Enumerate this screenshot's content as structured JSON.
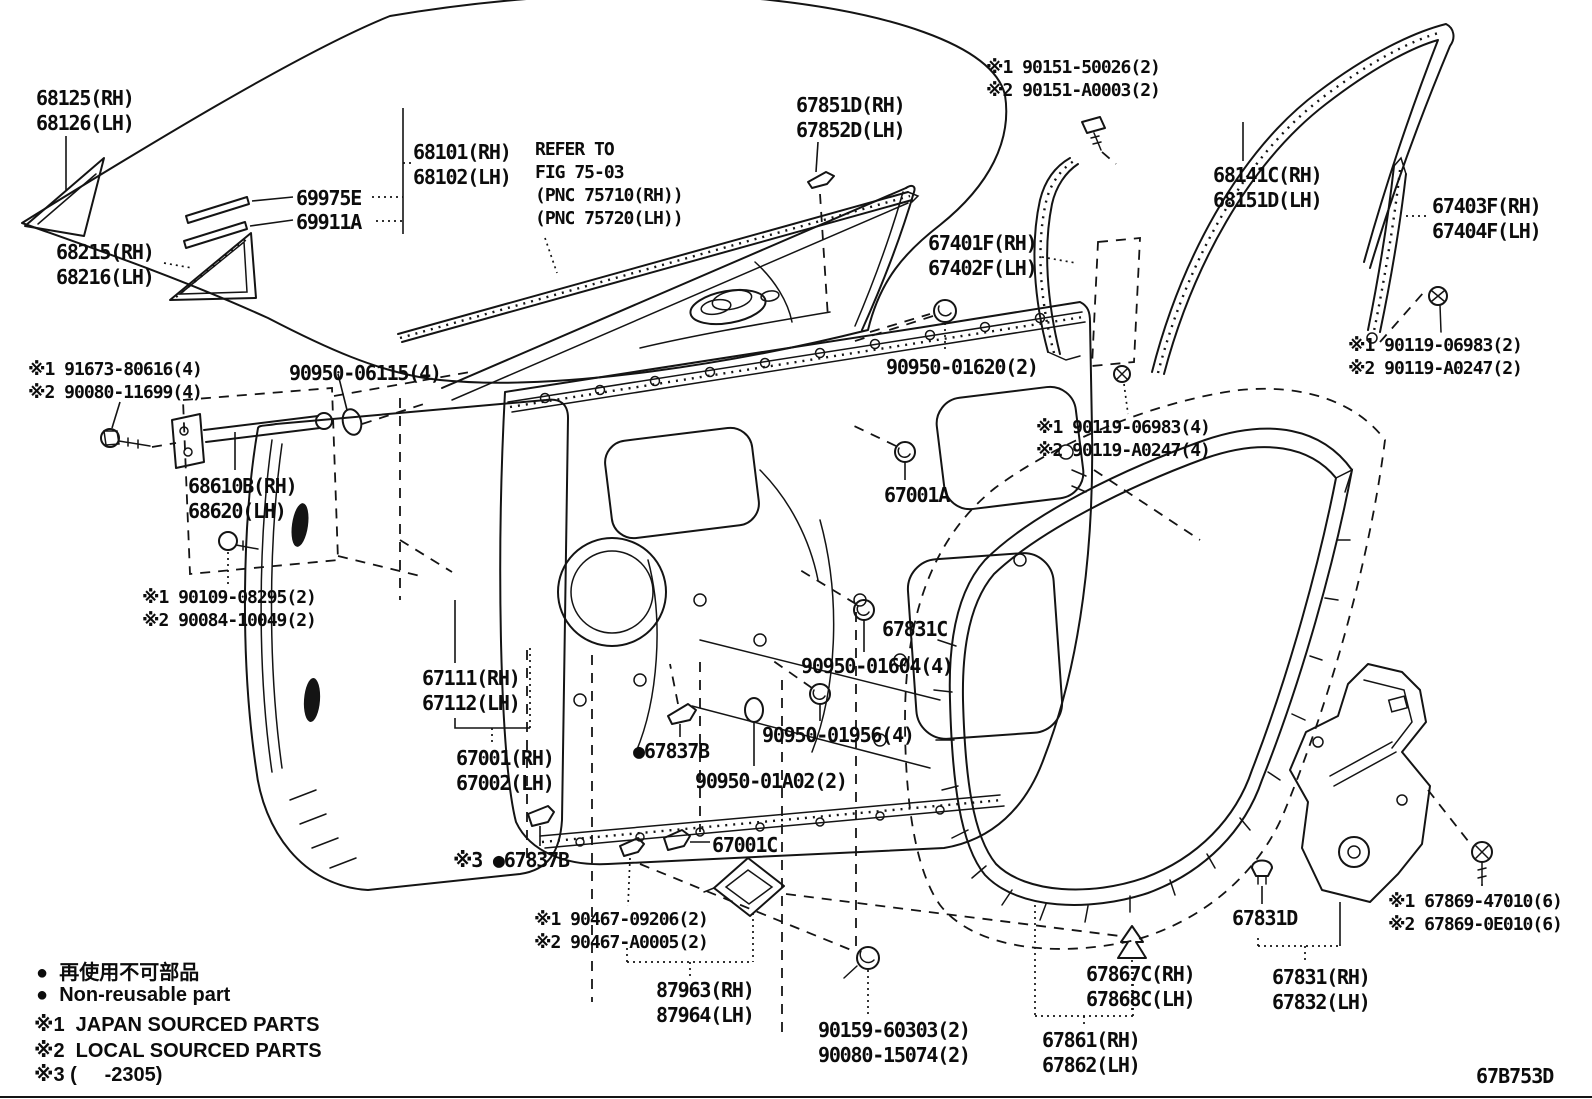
{
  "figure_code": "67B753D",
  "labels": {
    "glass_qtr": "68125(RH)\n68126(LH)",
    "door_glass": "68101(RH)\n68102(LH)",
    "ws_outer": "69975E",
    "ws_inner": "69911A",
    "vent_seal": "68215(RH)\n68216(LH)",
    "refer_note": "REFER TO\nFIG 75-03\n(PNC 75710(RH))\n(PNC 75720(LH))",
    "belt_mldg": "67851D(RH)\n67852D(LH)",
    "screw_90151": "※1 90151-50026(2)\n※2 90151-A0003(2)",
    "glass_run": "68141C(RH)\n68151D(LH)",
    "run_rear": "67403F(RH)\n67404F(LH)",
    "run_front": "67401F(RH)\n67402F(LH)",
    "gr_01620": "90950-01620(2)",
    "bolt_90119_2": "※1 90119-06983(2)\n※2 90119-A0247(2)",
    "bolt_90119_4": "※1 90119-06983(4)\n※2 90119-A0247(4)",
    "bolt_91673": "※1 91673-80616(4)\n※2 90080-11699(4)",
    "gr_06115": "90950-06115(4)",
    "door_check": "68610B(RH)\n68620(LH)",
    "bolt_90109": "※1 90109-08295(2)\n※2 90084-10049(2)",
    "p67001A": "67001A",
    "p67831C": "67831C",
    "gr_01604": "90950-01604(4)",
    "gr_01956": "90950-01956(4)",
    "clip_67837B": "●67837B",
    "gr_01A02": "90950-01A02(2)",
    "door_panel": "67111(RH)\n67112(LH)",
    "door_assy": "67001(RH)\n67002(LH)",
    "clip_67837B2": "※3 ●67837B",
    "p67001C": "67001C",
    "screw_90467": "※1 90467-09206(2)\n※2 90467-A0005(2)",
    "stabilizer": "87963(RH)\n87964(LH)",
    "screw_90159": "90159-60303(2)\n90080-15074(2)",
    "clip_67867C": "67867C(RH)\n67868C(LH)",
    "weatherstrip": "67861(RH)\n67862(LH)",
    "clip_67831D": "67831D",
    "hole_cover": "67831(RH)\n67832(LH)",
    "screw_67869": "※1 67869-47010(6)\n※2 67869-0E010(6)"
  },
  "legend": {
    "nonreusable_jp": "●  再使用不可部品",
    "nonreusable_en": "●  Non-reusable part",
    "note1": "※1  JAPAN SOURCED PARTS",
    "note2": "※2  LOCAL SOURCED PARTS",
    "note3": "※3 (     -2305)"
  },
  "colors": {
    "ink": "#141414",
    "paper": "#ffffff"
  }
}
